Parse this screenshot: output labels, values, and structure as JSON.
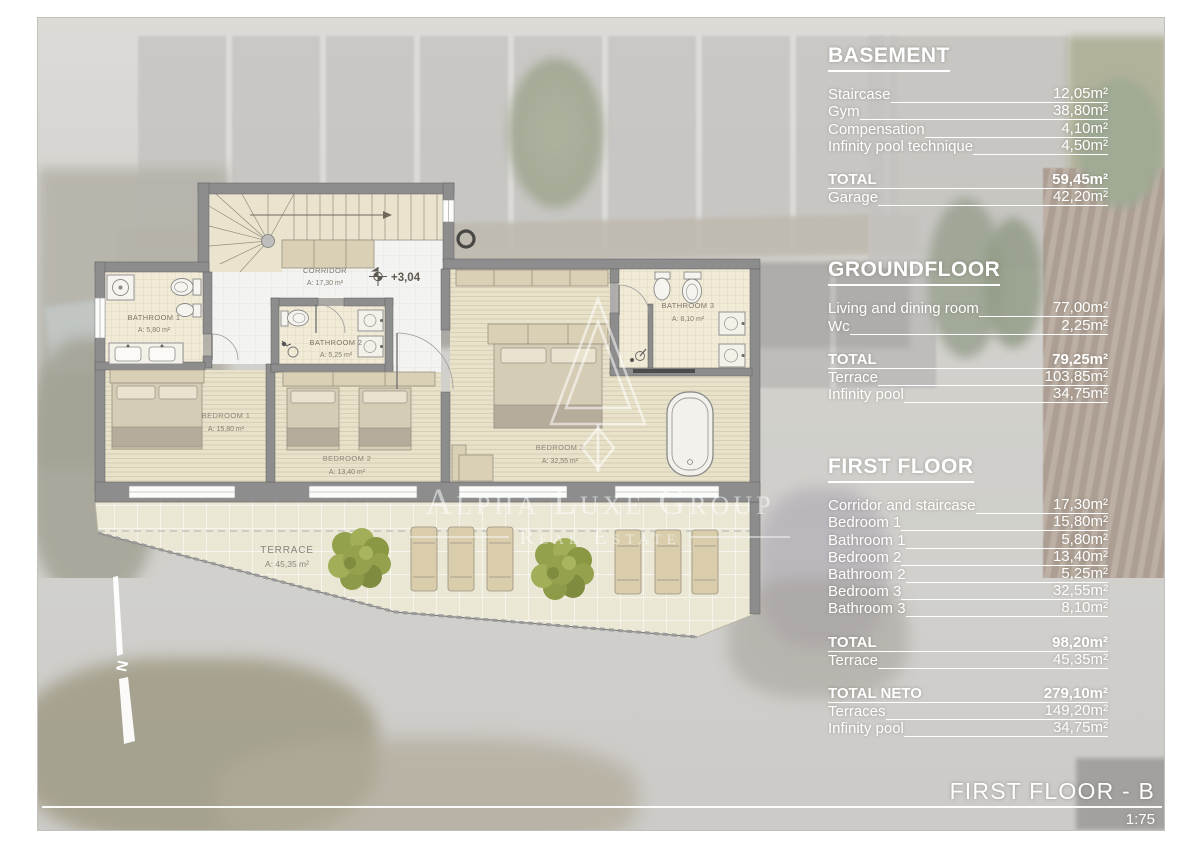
{
  "document": {
    "title": "FIRST FLOOR - B",
    "scale": "1:75",
    "level_marker": "+3,04",
    "north_label": "N"
  },
  "watermark": {
    "name": "Alpha Luxe Group",
    "tagline": "Real Estate"
  },
  "floor_plan": {
    "rooms": {
      "corridor": {
        "name": "CORRIDOR",
        "area": "A: 17,30 m²"
      },
      "bathroom1": {
        "name": "BATHROOM 1",
        "area": "A: 5,80 m²"
      },
      "bathroom2": {
        "name": "BATHROOM 2",
        "area": "A: 5,25 m²"
      },
      "bathroom3": {
        "name": "BATHROOM 3",
        "area": "A: 8,10 m²"
      },
      "bedroom1": {
        "name": "BEDROOM 1",
        "area": "A: 15,80 m²"
      },
      "bedroom2": {
        "name": "BEDROOM 2",
        "area": "A: 13,40 m²"
      },
      "bedroom3": {
        "name": "BEDROOM 3",
        "area": "A: 32,55 m²"
      },
      "terrace": {
        "name": "TERRACE",
        "area": "A: 45,35 m²"
      }
    }
  },
  "area_schedule": {
    "sections": [
      {
        "heading": "BASEMENT",
        "groups": [
          {
            "rows": [
              {
                "label": "Staircase",
                "value": "12,05m²"
              },
              {
                "label": "Gym",
                "value": "38,80m²"
              },
              {
                "label": "Compensation",
                "value": "4,10m²"
              },
              {
                "label": "Infinity pool technique",
                "value": "4,50m²"
              }
            ]
          },
          {
            "rows": [
              {
                "label": "TOTAL",
                "value": "59,45m²",
                "bold": true
              },
              {
                "label": "Garage",
                "value": "42,20m²"
              }
            ]
          }
        ]
      },
      {
        "heading": "GROUNDFLOOR",
        "groups": [
          {
            "rows": [
              {
                "label": "Living and dining room",
                "value": "77,00m²"
              },
              {
                "label": "Wc",
                "value": "2,25m²"
              }
            ]
          },
          {
            "rows": [
              {
                "label": "TOTAL",
                "value": "79,25m²",
                "bold": true
              },
              {
                "label": "Terrace",
                "value": "103,85m²"
              },
              {
                "label": "Infinity pool",
                "value": "34,75m²"
              }
            ]
          }
        ]
      },
      {
        "heading": "FIRST FLOOR",
        "groups": [
          {
            "rows": [
              {
                "label": "Corridor and staircase",
                "value": "17,30m²"
              },
              {
                "label": "Bedroom 1",
                "value": "15,80m²"
              },
              {
                "label": "Bathroom 1",
                "value": "5,80m²"
              },
              {
                "label": "Bedroom 2",
                "value": "13,40m²"
              },
              {
                "label": "Bathroom 2",
                "value": "5,25m²"
              },
              {
                "label": "Bedroom 3",
                "value": "32,55m²"
              },
              {
                "label": "Bathroom 3",
                "value": "8,10m²"
              }
            ]
          },
          {
            "rows": [
              {
                "label": "TOTAL",
                "value": "98,20m²",
                "bold": true
              },
              {
                "label": "Terrace",
                "value": "45,35m²"
              }
            ]
          },
          {
            "rows": [
              {
                "label": "TOTAL NETO",
                "value": "279,10m²",
                "bold": true
              },
              {
                "label": "Terraces",
                "value": "149,20m²"
              },
              {
                "label": "Infinity pool",
                "value": "34,75m²"
              }
            ]
          }
        ]
      }
    ]
  },
  "colors": {
    "wall": "#8d8d8d",
    "wood_floor": "#e8e2cb",
    "bathroom_tile": "#f0ead6",
    "terrace_tile": "#ebe7d5",
    "furniture": "#d9d0b6",
    "tree": "#96a14e",
    "panel_text": "#ffffff",
    "plan_label": "#7d766a"
  }
}
